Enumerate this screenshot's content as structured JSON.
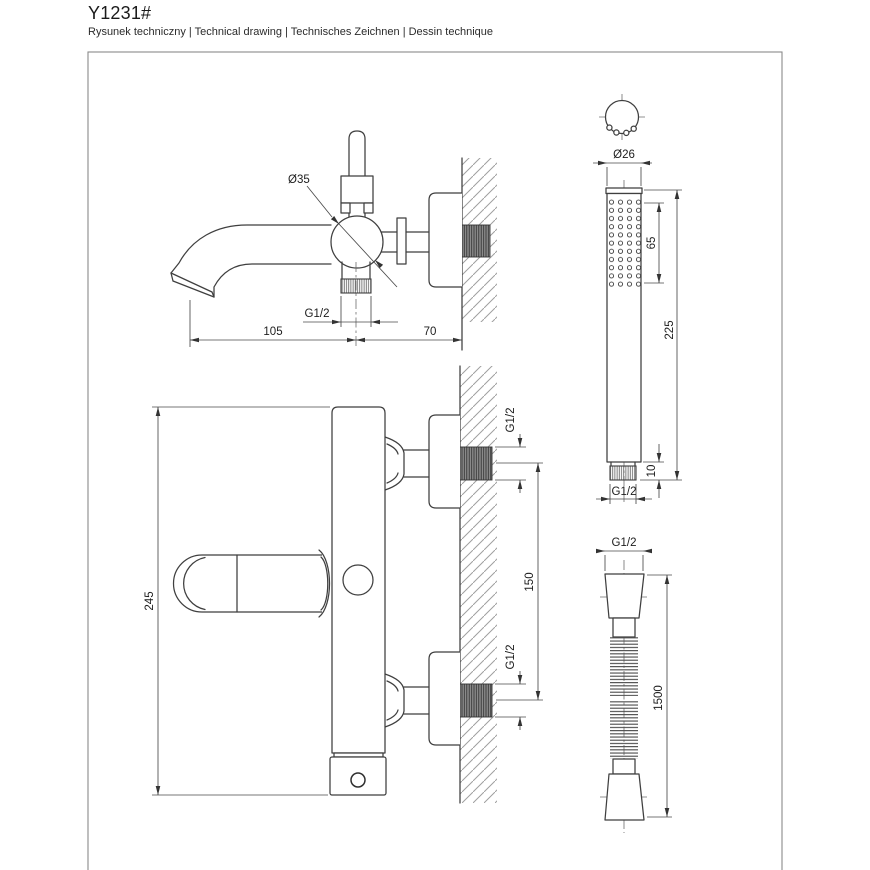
{
  "header": {
    "title": "Y1231#",
    "subtitle": "Rysunek techniczny | Technical drawing | Technisches Zeichnen | Dessin technique"
  },
  "colors": {
    "line": "#3f3f3f",
    "dimension": "#4a4a4a",
    "hatch": "#9f9f9f",
    "thread_fill": "#8f8f8f",
    "frame_border": "#8a8a8a",
    "text": "#1d1d1d"
  },
  "drawings": {
    "spout_side_view": {
      "description": "wall-mounted bath spout, side view",
      "dims": {
        "body_diameter": "Ø35",
        "outlet_thread": "G1/2",
        "spout_projection": "105",
        "wall_distance": "70"
      }
    },
    "hand_shower": {
      "description": "stick hand shower, top and front view",
      "dims": {
        "head_diameter": "Ø26",
        "spray_face_length": "65",
        "total_length": "225",
        "connector_length": "10",
        "connection_thread": "G1/2"
      }
    },
    "mixer_front_view": {
      "description": "wall-mounted mixer body, front view",
      "dims": {
        "body_height": "245",
        "connection_spacing": "150",
        "inlet_thread_top": "G1/2",
        "inlet_thread_bottom": "G1/2"
      }
    },
    "hose": {
      "description": "flexible shower hose",
      "dims": {
        "connection_thread": "G1/2",
        "length": "1500"
      }
    }
  }
}
